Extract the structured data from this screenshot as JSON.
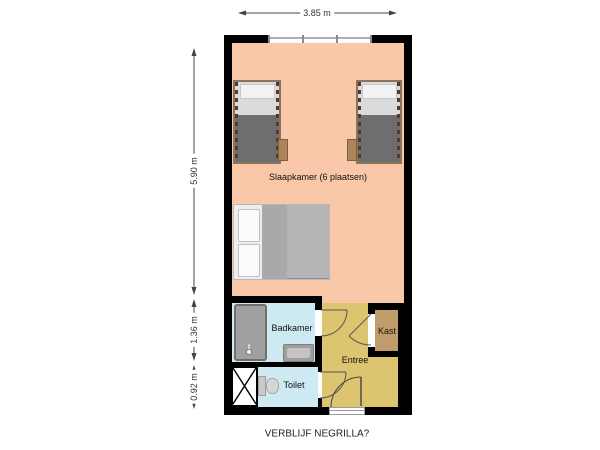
{
  "caption": "VERBLIJF NEGRILLA?",
  "dimensions": {
    "top_width": "3.85 m",
    "left_main": "5.90 m",
    "left_mid": "1.36 m",
    "left_bottom": "0.92 m"
  },
  "rooms": {
    "slaapkamer": {
      "label": "Slaapkamer (6 plaatsen)",
      "floor_color": "#f9c8a9"
    },
    "badkamer": {
      "label": "Badkamer",
      "floor_color": "#cde9f1"
    },
    "toilet": {
      "label": "Toilet",
      "floor_color": "#cde9f1"
    },
    "entree": {
      "label": "Entree",
      "floor_color": "#ddc46e"
    },
    "kast": {
      "label": "Kast",
      "floor_color": "#c09c6b"
    }
  },
  "colors": {
    "wall": "#000000",
    "bed_frame": "#8d7260",
    "bed_blanket_dark": "#6e6e6e",
    "bed_blanket_light": "#b5b5b5",
    "fixture_gray": "#a0a0a0",
    "dimension_text": "#333333"
  }
}
